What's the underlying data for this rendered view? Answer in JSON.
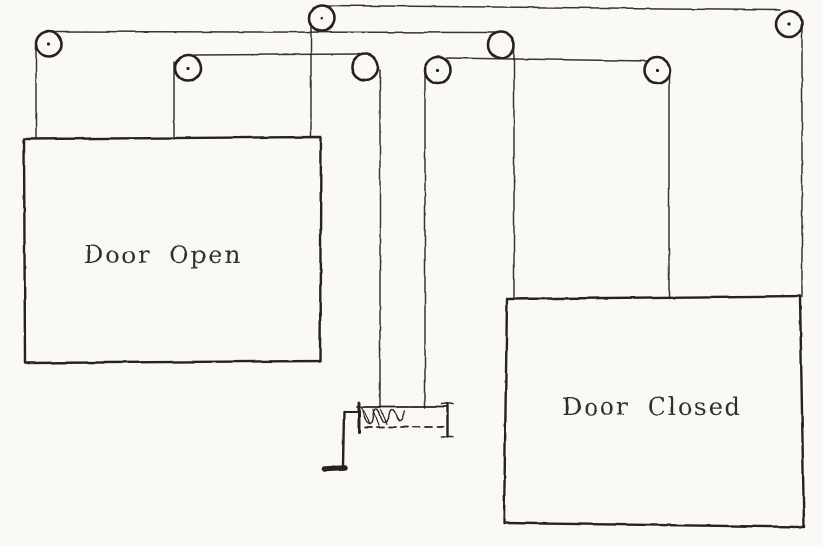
{
  "diagram": {
    "doors": [
      {
        "label": "Door Open"
      },
      {
        "label": "Door Closed"
      }
    ],
    "colors": {
      "ink": "#26231e",
      "paper": "#faf9f5"
    }
  }
}
